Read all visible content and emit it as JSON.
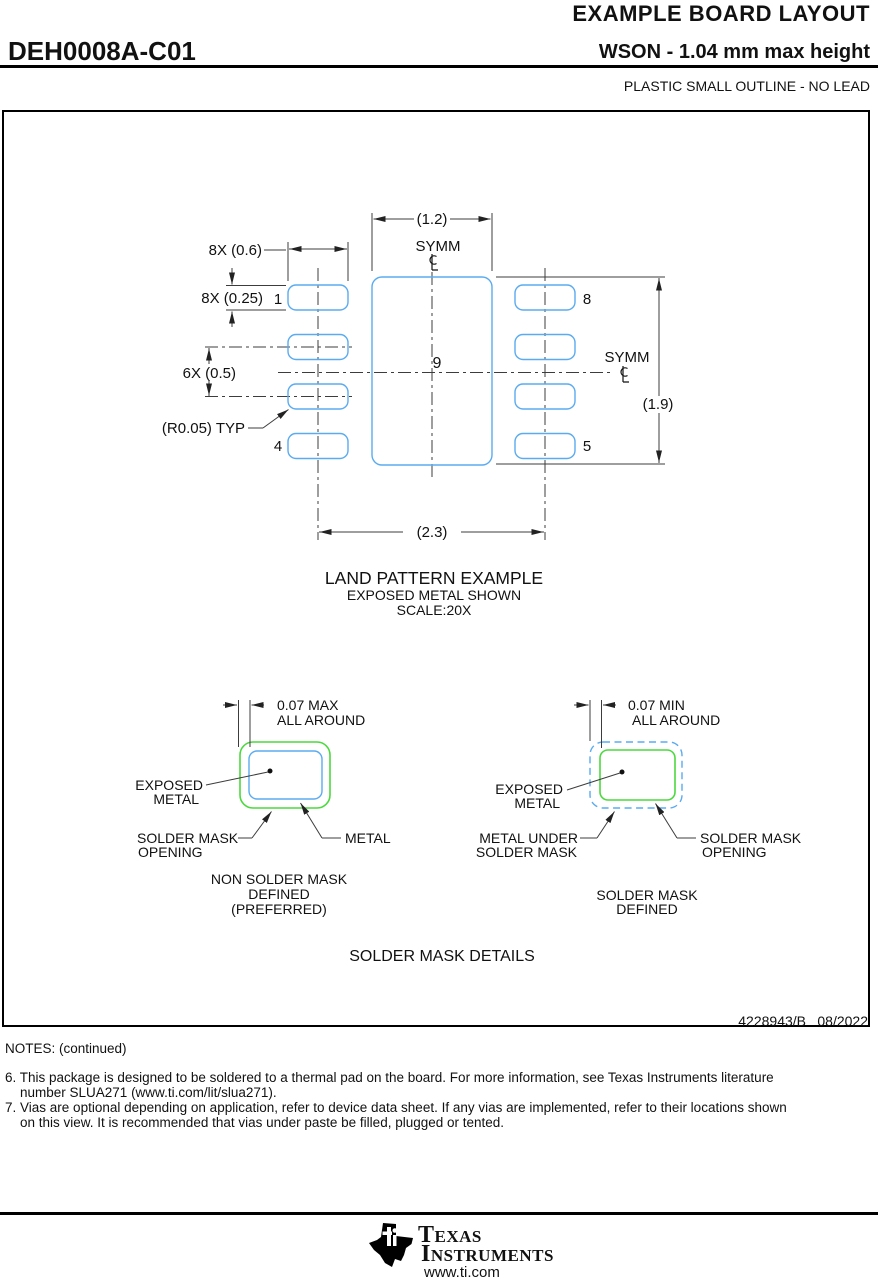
{
  "header": {
    "doc_title": "EXAMPLE BOARD LAYOUT",
    "part_number": "DEH0008A-C01",
    "package_desc": "WSON - 1.04 mm max height",
    "package_family": "PLASTIC SMALL OUTLINE - NO LEAD"
  },
  "land_pattern": {
    "symm": "SYMM",
    "centerline_symbol": "℄",
    "dim_pad9_width": "(1.2)",
    "dim_pad_width": "8X (0.6)",
    "dim_pad_height": "8X (0.25)",
    "dim_pitch": "6X (0.5)",
    "dim_corner_radius": "(R0.05) TYP",
    "dim_pad9_height": "(1.9)",
    "dim_row_span": "(2.3)",
    "pin1": "1",
    "pin4": "4",
    "pin5": "5",
    "pin8": "8",
    "pin9": "9",
    "title": "LAND PATTERN EXAMPLE",
    "subtitle1": "EXPOSED METAL SHOWN",
    "subtitle2": "SCALE:20X"
  },
  "nsmd": {
    "dim1": "0.07 MAX",
    "dim2": "ALL AROUND",
    "exposed1": "EXPOSED",
    "exposed2": "METAL",
    "opening1": "SOLDER MASK",
    "opening2": "OPENING",
    "metal": "METAL",
    "cap1": "NON SOLDER MASK",
    "cap2": "DEFINED",
    "cap3": "(PREFERRED)"
  },
  "smd": {
    "dim1": "0.07 MIN",
    "dim2": "ALL AROUND",
    "exposed1": "EXPOSED",
    "exposed2": "METAL",
    "metal_under1": "METAL UNDER",
    "metal_under2": "SOLDER MASK",
    "opening1": "SOLDER MASK",
    "opening2": "OPENING",
    "cap1": "SOLDER MASK",
    "cap2": "DEFINED"
  },
  "section_title": "SOLDER MASK DETAILS",
  "title_block": {
    "number": "4228943/B",
    "date": "08/2022"
  },
  "notes": {
    "heading": "NOTES: (continued)",
    "items": [
      {
        "num": "6.",
        "line1": "This package is designed to be soldered to a thermal pad on the board. For more information, see Texas Instruments literature",
        "line2": "number SLUA271 (www.ti.com/lit/slua271)."
      },
      {
        "num": "7.",
        "line1": "Vias are optional depending on application, refer to device data sheet. If any vias are implemented, refer to their locations shown",
        "line2": "on this view. It is recommended that vias under paste be filled, plugged or tented."
      }
    ]
  },
  "brand": {
    "name1": "Texas",
    "name2": "Instruments",
    "url": "www.ti.com"
  }
}
